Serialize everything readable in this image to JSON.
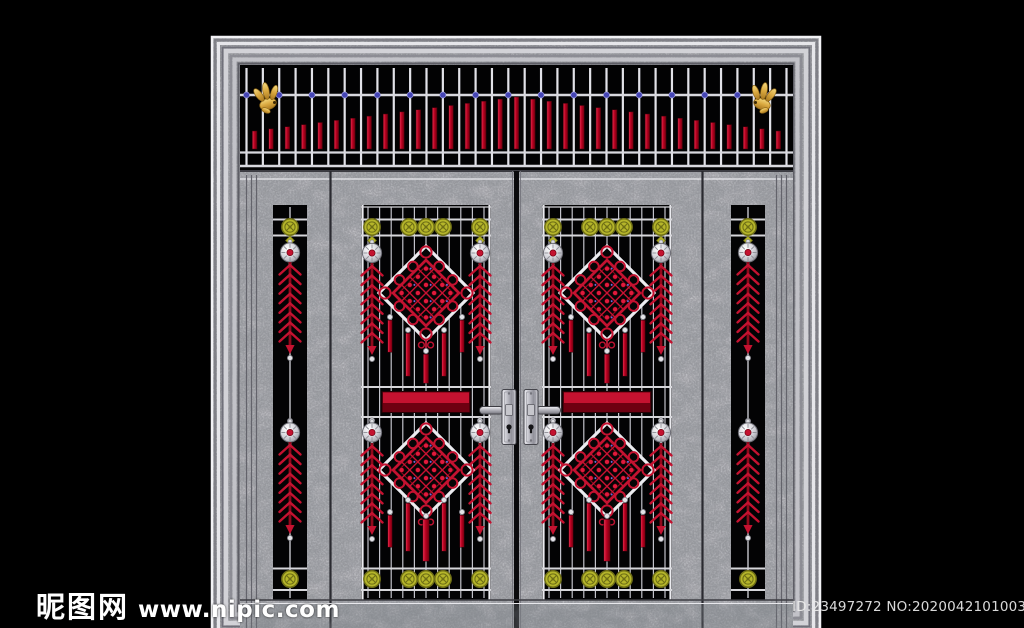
{
  "page": {
    "background": "#000000",
    "width": 1024,
    "height": 628
  },
  "watermarks": {
    "site_logo_text": "昵图网",
    "site_url": "www.nipic.com",
    "image_id": "ID:23497272 NO:20200421010039240086"
  },
  "palette": {
    "black": "#000000",
    "steel_light": "#cfcfd3",
    "steel_frame": "#c6c6ca",
    "bar_silver": "#e2e2e8",
    "red_bright": "#c41230",
    "red_dark": "#8f0a1c",
    "lock_rail_dark": "#6e0011",
    "gold": "#d9a83f",
    "olive": "#b5b52a",
    "olive_dark": "#6f6f16",
    "blue_dot": "#4444b4"
  },
  "door_design": {
    "description": "stainless steel double entry door with ornamental red grille work",
    "transom": {
      "vertical_bars": 34,
      "red_picket_bars": 33,
      "blue_dots": 17,
      "goldfish_ornaments": 2,
      "picket_min_height": 18,
      "picket_max_height": 52
    },
    "side_panels": {
      "count": 2,
      "flower_medallions_each": 2,
      "silver_balls_each": 2,
      "wheat_ears_each": 2
    },
    "door_leaves": {
      "count": 2,
      "flower_medallions_each": 10,
      "silver_balls_each": 4,
      "wheat_ears_each": 4,
      "knot_diamonds_each": 2,
      "tassels_each": 10,
      "lock_rails_each": 1
    },
    "handles": {
      "count": 2,
      "type": "lever-with-keyhole"
    }
  }
}
